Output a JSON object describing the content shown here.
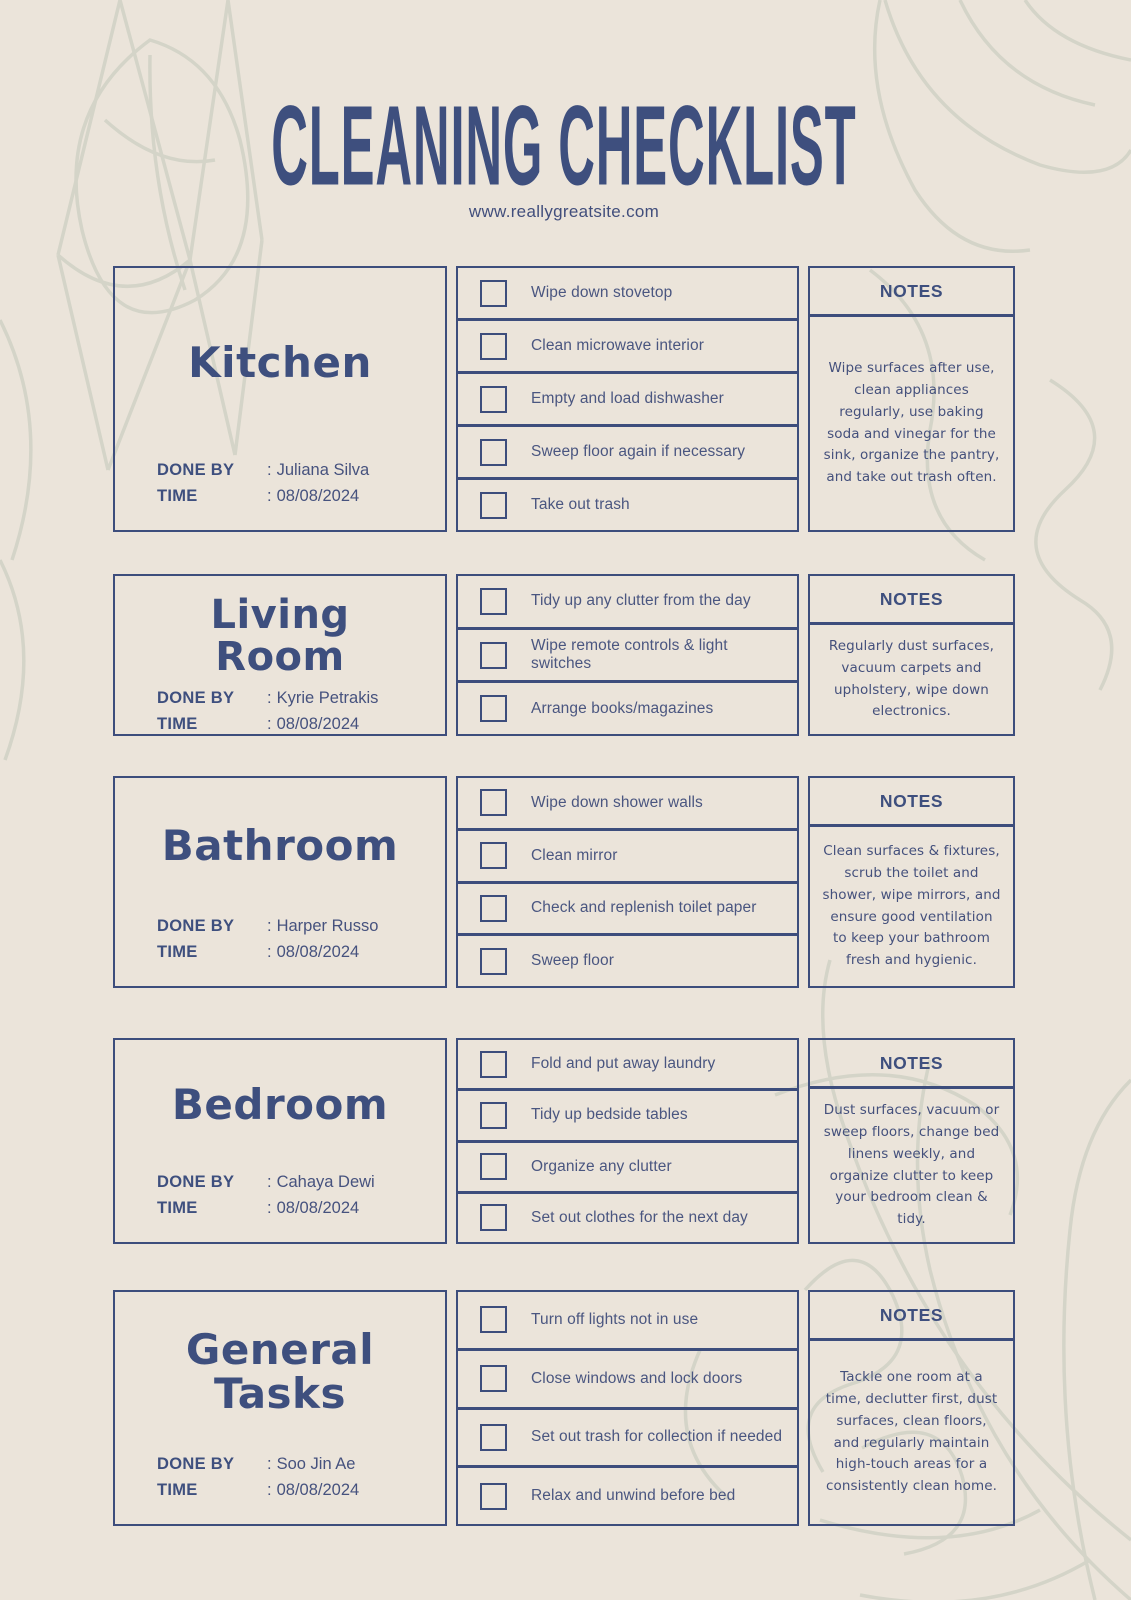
{
  "page": {
    "title": "CLEANING CHECKLIST",
    "website": "www.reallygreatsite.com",
    "notes_header": "NOTES",
    "done_by_label": "DONE BY",
    "time_label": "TIME",
    "colon": ":",
    "colors": {
      "background": "#EBE4DA",
      "ink_navy": "#3E4F7E",
      "body_text": "#4A5680",
      "doodle_green": "#D0D2C5"
    }
  },
  "sections": [
    {
      "name": "Kitchen",
      "done_by": "Juliana Silva",
      "time": "08/08/2024",
      "tasks": [
        "Wipe down stovetop",
        "Clean microwave interior",
        "Empty and load dishwasher",
        "Sweep floor again if necessary",
        "Take out trash"
      ],
      "notes": "Wipe surfaces after use, clean appliances regularly, use baking soda and vinegar for the sink, organize the pantry, and take out trash often."
    },
    {
      "name": "Living Room",
      "done_by": "Kyrie Petrakis",
      "time": "08/08/2024",
      "tasks": [
        "Tidy up any clutter from the day",
        "Wipe remote controls & light switches",
        "Arrange books/magazines"
      ],
      "notes": "Regularly dust surfaces, vacuum carpets and upholstery, wipe down electronics."
    },
    {
      "name": "Bathroom",
      "done_by": "Harper Russo",
      "time": "08/08/2024",
      "tasks": [
        "Wipe down shower walls",
        "Clean mirror",
        "Check and replenish toilet paper",
        "Sweep floor"
      ],
      "notes": "Clean surfaces & fixtures, scrub the toilet and shower, wipe mirrors, and ensure good ventilation to keep your bathroom fresh and hygienic."
    },
    {
      "name": "Bedroom",
      "done_by": "Cahaya Dewi",
      "time": "08/08/2024",
      "tasks": [
        "Fold and put away laundry",
        "Tidy up bedside tables",
        "Organize any clutter",
        "Set out clothes for the next day"
      ],
      "notes": "Dust surfaces, vacuum or sweep floors, change bed linens weekly, and organize clutter to keep your bedroom clean & tidy."
    },
    {
      "name": "General Tasks",
      "done_by": "Soo Jin Ae",
      "time": "08/08/2024",
      "tasks": [
        "Turn off lights not in use",
        "Close windows and lock doors",
        "Set out trash for collection if needed",
        "Relax and unwind before bed"
      ],
      "notes": "Tackle one room at a time, declutter first, dust surfaces, clean floors, and regularly maintain high-touch areas for a consistently clean home."
    }
  ]
}
